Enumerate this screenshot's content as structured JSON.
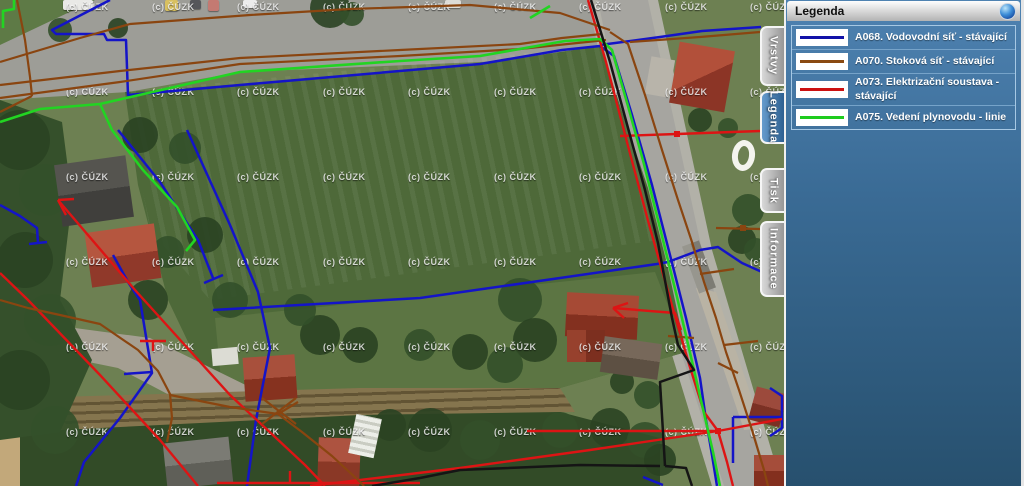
{
  "panel": {
    "title": "Legenda",
    "collapse_icon": "blue-sphere-collapse-button",
    "tabs": [
      {
        "label": "Vrstvy",
        "active": false,
        "y": 26,
        "h": 60
      },
      {
        "label": "Legenda",
        "active": true,
        "y": 91,
        "h": 53
      },
      {
        "label": "Tisk",
        "active": false,
        "y": 168,
        "h": 45
      },
      {
        "label": "Informace",
        "active": false,
        "y": 221,
        "h": 76
      }
    ],
    "legend_items": [
      {
        "label": "A068. Vodovodní síť - stávající",
        "color": "#1212a8"
      },
      {
        "label": "A070. Stoková síť - stávající",
        "color": "#8a4a12"
      },
      {
        "label": "A073. Elektrizační soustava - stávající",
        "color": "#cc1111"
      },
      {
        "label": "A075. Vedení plynovodu - linie",
        "color": "#1ecc1e"
      }
    ]
  },
  "map": {
    "watermark_text": "(c) ČÚZK",
    "watermark_cols": [
      66,
      152,
      237,
      323,
      408,
      494,
      579,
      665,
      750
    ],
    "watermark_rows": [
      2,
      87,
      172,
      257,
      342,
      427
    ],
    "colors": {
      "water": "#1414c8",
      "sewer": "#8a4510",
      "power": "#dd1414",
      "gas": "#22d422",
      "boundary": "#151515"
    },
    "vehicles": [
      {
        "x": 63,
        "y": 0,
        "w": 30,
        "h": 10,
        "c": "#e9e9e6"
      },
      {
        "x": 165,
        "y": 0,
        "w": 13,
        "h": 11,
        "c": "#d8c060"
      },
      {
        "x": 190,
        "y": 0,
        "w": 11,
        "h": 9,
        "c": "#55565a"
      },
      {
        "x": 208,
        "y": 0,
        "w": 11,
        "h": 11,
        "c": "#c47a72"
      },
      {
        "x": 243,
        "y": 0,
        "w": 14,
        "h": 8,
        "c": "#ececec"
      },
      {
        "x": 445,
        "y": 0,
        "w": 16,
        "h": 8,
        "c": "#dddcd8"
      }
    ],
    "lines": [
      {
        "kind": "water",
        "pts": "110,0 52,30 56,34 104,34 107,40 126,40 128,95 240,85 480,64 562,50 600,46 614,56 632,115 652,185 670,255 686,318 700,378 706,420 712,455 717,486"
      },
      {
        "kind": "water",
        "pts": "600,45 660,37 702,31 761,27"
      },
      {
        "kind": "water",
        "pts": "118,130 160,182 198,240 213,278"
      },
      {
        "kind": "water",
        "pts": "204,283 223,275"
      },
      {
        "kind": "water",
        "pts": "187,130 230,225 258,292 270,348 256,420 247,486"
      },
      {
        "kind": "water",
        "pts": "0,205 20,216 37,228 38,243"
      },
      {
        "kind": "water",
        "pts": "29,244 47,242"
      },
      {
        "kind": "water",
        "pts": "113,255 128,282 140,300 152,373 120,418 84,462 76,486"
      },
      {
        "kind": "water",
        "pts": "124,374 152,372"
      },
      {
        "kind": "water",
        "pts": "213,310 420,298 560,278 657,264 668,262"
      },
      {
        "kind": "water",
        "pts": "668,262 700,250 718,247 742,263 762,272 783,283"
      },
      {
        "kind": "water",
        "pts": "733,417 783,417"
      },
      {
        "kind": "water",
        "pts": "733,417 733,463"
      },
      {
        "kind": "water",
        "pts": "643,477 663,485"
      },
      {
        "kind": "water",
        "pts": "770,388 782,396 782,428 770,436"
      },
      {
        "kind": "power",
        "pts": "58,200 135,290 230,395 305,465 325,486"
      },
      {
        "kind": "power",
        "pts": "58,200 74,199"
      },
      {
        "kind": "power",
        "pts": "58,200 66,215"
      },
      {
        "kind": "power",
        "pts": "0,273 28,300 100,375 160,440 198,486"
      },
      {
        "kind": "power",
        "pts": "310,486 460,468 590,450 718,431"
      },
      {
        "kind": "power",
        "pts": "527,431 718,431"
      },
      {
        "kind": "power",
        "pts": "718,431 782,419"
      },
      {
        "kind": "power",
        "pts": "588,0 606,62 628,146 650,228 671,302 689,364 704,412 718,431 727,462 733,486"
      },
      {
        "kind": "power",
        "pts": "620,136 677,134 760,131"
      },
      {
        "kind": "power",
        "pts": "613,308 675,313 681,330"
      },
      {
        "kind": "power",
        "pts": "613,308 628,303"
      },
      {
        "kind": "power",
        "pts": "613,308 624,318"
      },
      {
        "kind": "power",
        "pts": "217,483 420,483"
      },
      {
        "kind": "power",
        "pts": "290,483 290,471"
      },
      {
        "kind": "power",
        "pts": "140,341 166,341"
      },
      {
        "kind": "power",
        "pts": "153,341 153,351"
      },
      {
        "kind": "sewer",
        "pts": "0,62 80,38 130,24 250,15 350,9 470,5 560,13 610,30"
      },
      {
        "kind": "sewer",
        "pts": "0,85 120,71 240,58 400,50 520,44 562,38 602,34"
      },
      {
        "kind": "sewer",
        "pts": "0,98 120,82 240,64 400,56 520,49 606,40"
      },
      {
        "kind": "sewer",
        "pts": "17,0 25,40 30,77 32,96"
      },
      {
        "kind": "sewer",
        "pts": "32,96 12,106 0,112"
      },
      {
        "kind": "sewer",
        "pts": "610,32 628,44 645,95 662,150 678,200 692,242 704,282 716,318 726,352 739,390 752,430 764,470 768,486"
      },
      {
        "kind": "sewer",
        "pts": "630,42 700,37 760,32"
      },
      {
        "kind": "sewer",
        "pts": "716,228 760,229"
      },
      {
        "kind": "sewer",
        "pts": "700,274 734,269"
      },
      {
        "kind": "sewer",
        "pts": "724,345 758,341"
      },
      {
        "kind": "sewer",
        "pts": "668,336 694,338"
      },
      {
        "kind": "sewer",
        "pts": "718,363 738,373"
      },
      {
        "kind": "sewer",
        "pts": "0,300 28,308 60,315 100,324 138,350 158,371 170,394 172,418 167,442"
      },
      {
        "kind": "sewer",
        "pts": "170,395 230,407 278,414 302,432 332,456 358,480 364,486"
      },
      {
        "kind": "sewer",
        "pts": "278,414 298,402"
      },
      {
        "kind": "sewer",
        "pts": "262,398 296,424"
      },
      {
        "kind": "sewer",
        "pts": "262,424 296,398"
      },
      {
        "kind": "gas",
        "pts": "0,122 40,109 100,104 240,72 400,61 480,56 565,41 600,39 612,50 628,106 644,164 661,232 677,297 691,357 703,409 713,452 720,486"
      },
      {
        "kind": "gas",
        "pts": "100,104 112,130 143,170 177,207 195,240 186,251"
      },
      {
        "kind": "gas",
        "pts": "14,0 14,9 3,11 3,28"
      },
      {
        "kind": "gas",
        "pts": "530,18 550,6"
      },
      {
        "kind": "boundary",
        "pts": "591,0 610,62 628,128 645,190 658,243 672,318 678,345 694,370 660,382 665,466"
      },
      {
        "kind": "boundary",
        "pts": "660,466 580,465 460,470 420,478 372,486"
      },
      {
        "kind": "boundary",
        "pts": "665,466 686,468 692,486"
      }
    ],
    "markers": [
      {
        "kind": "power",
        "x": 677,
        "y": 134
      },
      {
        "kind": "power",
        "x": 718,
        "y": 431
      },
      {
        "kind": "sewer",
        "x": 743,
        "y": 228
      }
    ]
  }
}
